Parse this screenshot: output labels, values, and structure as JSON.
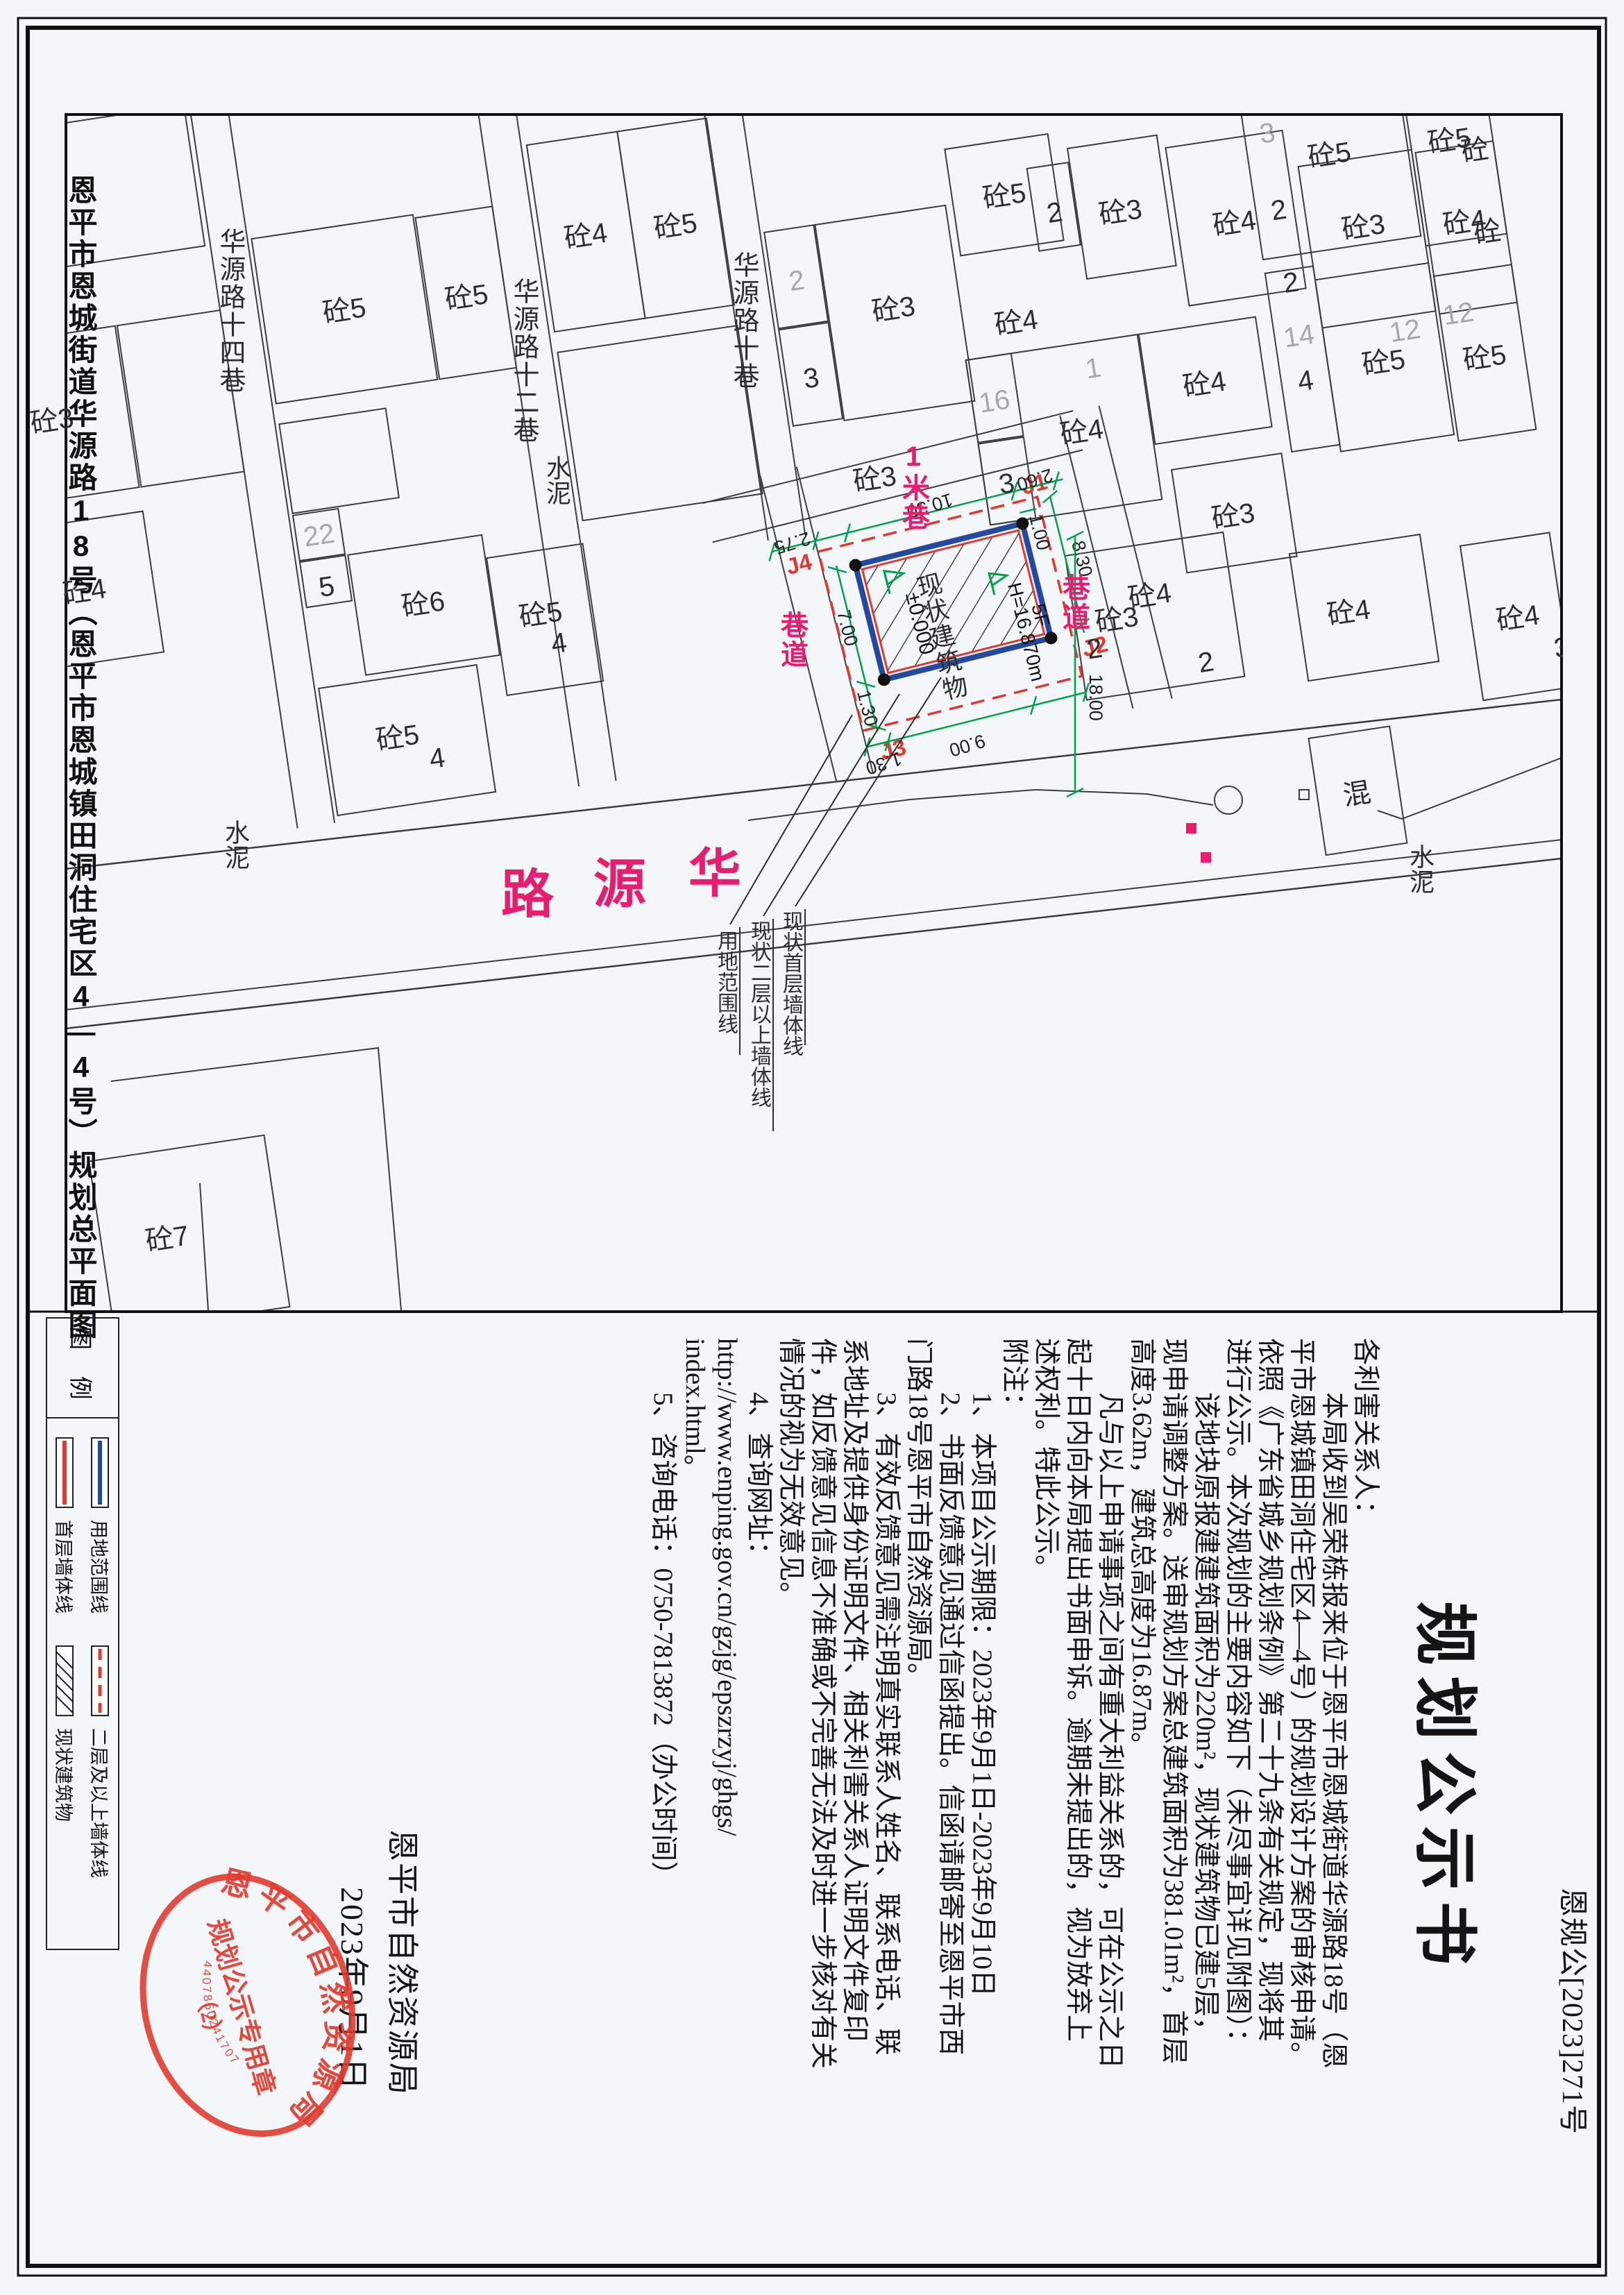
{
  "page": {
    "caption": "恩平市恩城街道华源路18号（恩平市恩城镇田洞住宅区4—4号）规划总平面图"
  },
  "panel": {
    "doc_no": "恩规公[2023]271号",
    "title": "规划公示书",
    "lines": [
      "各利害关系人：",
      "　　本局收到吴荣栋报来位于恩平市恩城街道华源路18号（恩",
      "平市恩城镇田洞住宅区4—4号）的规划设计方案的审核申请。",
      "依照《广东省城乡规划条例》第二十九条有关规定，现将其",
      "进行公示。本次规划的主要内容如下（未尽事宜详见附图）：",
      "　　该地块原报建建筑面积为220m²，现状建筑物已建5层，",
      "现申请调整方案。送审规划方案总建筑面积为381.01m²，首层",
      "高度3.62m，建筑总高度为16.87m。",
      "　　凡与以上申请事项之间有重大利益关系的，可在公示之日",
      "起十日内向本局提出书面申诉。逾期未提出的，视为放弃上",
      "述权利。特此公示。",
      "附注：",
      "　　1、本项目公示期限：2023年9月1日-2023年9月10日",
      "　　2、书面反馈意见通过信函提出。信函请邮寄至恩平市西",
      "门路18号恩平市自然资源局。",
      "　　3、有效反馈意见需注明真实联系人姓名、联系电话、联",
      "系地址及提供身份证明文件、相关利害关系人证明文件复印",
      "件，如反馈意见信息不准确或不完善无法及时进一步核对有关",
      "情况的视为无效意见。",
      "　　4、查询网址：",
      "http://www.enping.gov.cn/gzjg/epszrzyj/ghgs/",
      "index.html。",
      "　　5、咨询电话：0750-7813872（办公时间）"
    ],
    "signature": {
      "agency": "恩平市自然资源局",
      "date": "2023年9月1日"
    },
    "seal": {
      "ring_text": "恩平市自然资源局",
      "center": "规划公示专用章",
      "number": "（2）",
      "code": "4407850241707"
    },
    "legend": {
      "title": "图 例",
      "items": [
        "用地范围线",
        "首层墙体线",
        "二层及以上墙体线",
        "现状建筑物"
      ]
    }
  },
  "map": {
    "road": {
      "name": "华源路",
      "c0": "华",
      "c1": "源",
      "c2": "路"
    },
    "lanes": [
      "华源路十巷",
      "华源路十二巷",
      "华源路十四巷"
    ],
    "alleys": [
      "1米巷",
      "巷道",
      "巷道"
    ],
    "surface": [
      "水泥",
      "水泥",
      "水泥"
    ],
    "labels": [
      "砼4",
      "砼3",
      "砼4",
      "砼5",
      "砼5",
      "22",
      "5",
      "砼6",
      "砼5",
      "4",
      "砼5",
      "4",
      "砼4",
      "砼5",
      "2",
      "3",
      "砼3",
      "砼5",
      "砼4",
      "砼3",
      "2",
      "砼3",
      "砼4",
      "16",
      "3",
      "砼4",
      "砼4",
      "砼3",
      "砼4",
      "砼3",
      "2",
      "2",
      "砼4",
      "砼4",
      "3",
      "3",
      "砼5",
      "砼5",
      "2",
      "砼3",
      "砼4",
      "2",
      "14",
      "4",
      "砼5",
      "12",
      "12",
      "砼5",
      "砼5",
      "砼4",
      "砼7",
      "混",
      "1"
    ],
    "site": {
      "name": "现状建筑物",
      "level": "±0.000",
      "height": "H=16.870m",
      "floors": "5F",
      "j": [
        "J1",
        "J2",
        "J3",
        "J4"
      ],
      "dims": {
        "d275": "2.75",
        "d1030": "10.30",
        "d260": "2.60",
        "d100": "1.00",
        "d700": "7.00",
        "d830": "8.30",
        "d130a": "1.30",
        "d900": "9.00",
        "d130b": "1.30",
        "d1800": "18.00"
      },
      "leaders": [
        "现状首层墙体线",
        "现状二层以上墙体线",
        "用地范围线"
      ]
    }
  }
}
